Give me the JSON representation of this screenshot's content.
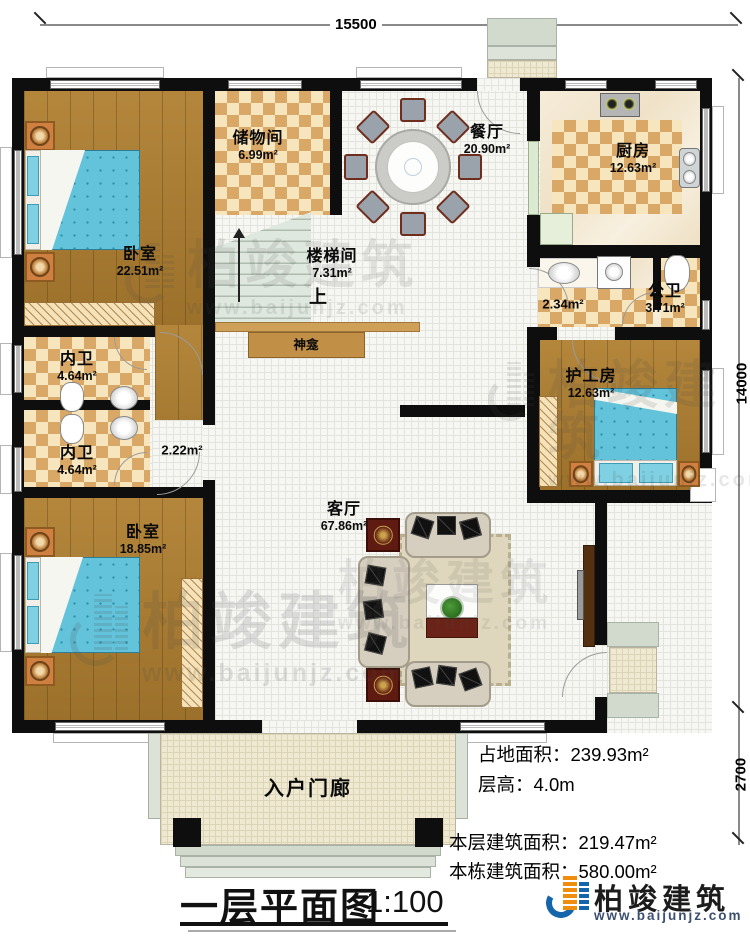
{
  "dimensions": {
    "top": "15500",
    "side": "14000",
    "porch": "2700"
  },
  "rooms": {
    "bedroom1": {
      "name": "卧室",
      "area": "22.51m²"
    },
    "storage": {
      "name": "储物间",
      "area": "6.99m²"
    },
    "stairwell": {
      "name": "楼梯间",
      "area": "7.31m²"
    },
    "stairs_up": {
      "label": "上"
    },
    "dining": {
      "name": "餐厅",
      "area": "20.90m²"
    },
    "kitchen": {
      "name": "厨房",
      "area": "12.63m²"
    },
    "hall": {
      "area": "2.34m²"
    },
    "public_bath": {
      "name": "公卫",
      "area": "3.71m²"
    },
    "caregiver": {
      "name": "护工房",
      "area": "12.63m²"
    },
    "bath1": {
      "name": "内卫",
      "area": "4.64m²"
    },
    "bath2": {
      "name": "内卫",
      "area": "4.64m²"
    },
    "vestibule": {
      "area": "2.22m²"
    },
    "bedroom2": {
      "name": "卧室",
      "area": "18.85m²"
    },
    "living": {
      "name": "客厅",
      "area": "67.86m²"
    },
    "shrine": {
      "name": "神龛"
    },
    "porch": {
      "name": "入户门廊"
    }
  },
  "stats": {
    "land": {
      "label": "占地面积：",
      "value": "239.93m²"
    },
    "height": {
      "label": "层高：",
      "value": "4.0m"
    },
    "floor_area": {
      "label": "本层建筑面积：",
      "value": "219.47m²"
    },
    "total_area": {
      "label": "本栋建筑面积：",
      "value": "580.00m²"
    }
  },
  "title": {
    "text": "一层平面图",
    "scale": "1:100"
  },
  "brand": {
    "name": "柏竣建筑",
    "site": "www.baijunjz.com"
  },
  "watermark": {
    "text": "柏竣建筑",
    "site": "www.baijunjz.com"
  },
  "colors": {
    "accent_blue": "#1565ab",
    "accent_orange": "#ef8d0d",
    "wall": "#0e0e0e"
  }
}
